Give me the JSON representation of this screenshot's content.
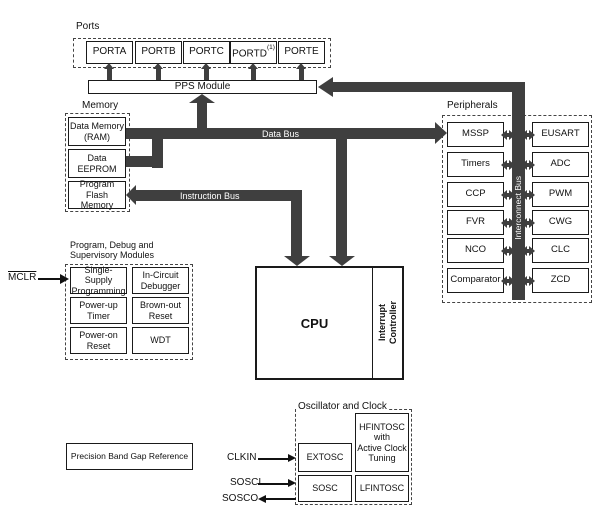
{
  "colors": {
    "bus": "#3f3f3f",
    "ink": "#1a1a1a",
    "background": "#ffffff"
  },
  "ports": {
    "label": "Ports",
    "items": [
      "PORTA",
      "PORTB",
      "PORTC",
      "PORTD",
      "PORTE"
    ],
    "portd_note": "(1)"
  },
  "pps": {
    "label": "PPS Module"
  },
  "memory": {
    "label": "Memory",
    "ram": [
      "Data Memory",
      "(RAM)"
    ],
    "eeprom": [
      "Data",
      "EEPROM"
    ],
    "flash": [
      "Program",
      "Flash Memory"
    ]
  },
  "buses": {
    "data": "Data Bus",
    "instruction": "Instruction Bus",
    "interconnect": "Interconnect Bus"
  },
  "cpu": {
    "label": "CPU",
    "interrupt": [
      "Interrupt",
      "Controller"
    ]
  },
  "peripherals": {
    "label": "Peripherals",
    "left": [
      "MSSP",
      "Timers",
      "CCP",
      "FVR",
      "NCO",
      "Comparator"
    ],
    "right": [
      "EUSART",
      "ADC",
      "PWM",
      "CWG",
      "CLC",
      "ZCD"
    ]
  },
  "debug": {
    "label": [
      "Program, Debug and",
      "Supervisory Modules"
    ],
    "mclr": "MCLR",
    "cells": [
      [
        "Single-Supply",
        "Programming"
      ],
      [
        "In-Circuit",
        "Debugger"
      ],
      [
        "Power-up",
        "Timer"
      ],
      [
        "Brown-out",
        "Reset"
      ],
      [
        "Power-on",
        "Reset"
      ],
      [
        "WDT"
      ]
    ]
  },
  "oscillator": {
    "label": "Oscillator and Clock",
    "extosc": "EXTOSC",
    "hfintosc": [
      "HFINTOSC",
      "with",
      "Active Clock",
      "Tuning"
    ],
    "sosc": "SOSC",
    "lfintosc": "LFINTOSC",
    "clkin": "CLKIN",
    "sosci": "SOSCI",
    "sosco": "SOSCO"
  },
  "bandgap": {
    "label": "Precision Band Gap Reference"
  }
}
